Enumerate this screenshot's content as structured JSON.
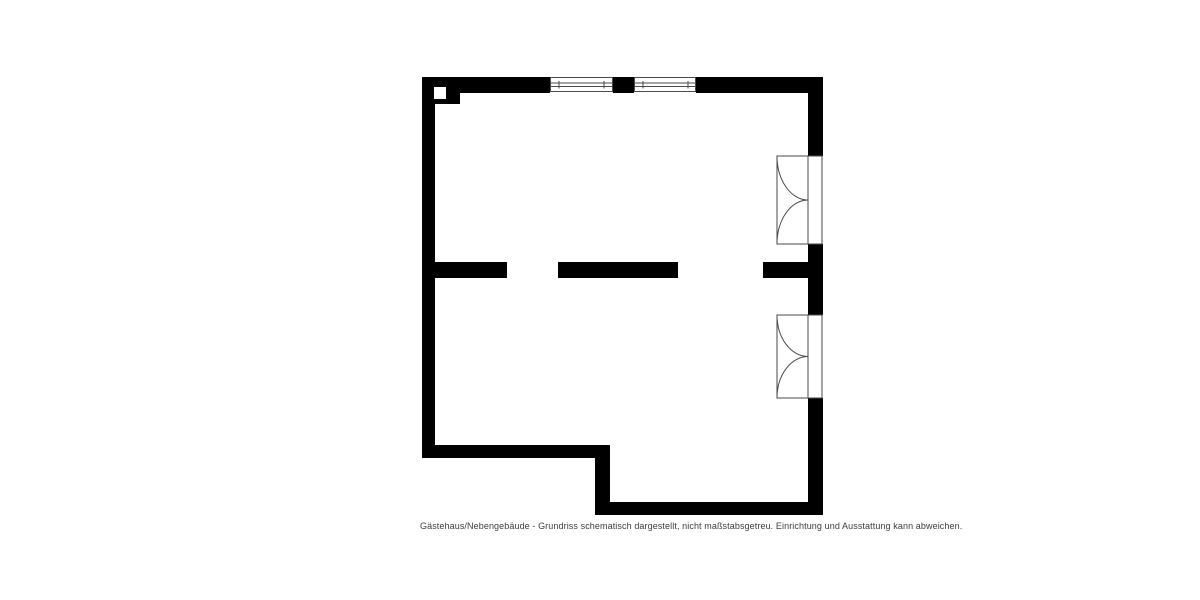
{
  "floorplan": {
    "caption": "Gästehaus/Nebengebäude - Grundriss schematisch dargestellt, nicht maßstabsgetreu. Einrichtung und Ausstattung kann abweichen.",
    "building_label": "Gästehaus/Nebengebäude",
    "colors": {
      "wall": "#000000",
      "background": "#ffffff",
      "caption_text": "#3c3c3c",
      "symbol_line": "#4a4a4a"
    },
    "symbols": {
      "window": "window-icon",
      "double_door": "double-door-swing-icon",
      "chimney": "chimney-flue-icon",
      "door_opening": "wall-opening"
    }
  }
}
